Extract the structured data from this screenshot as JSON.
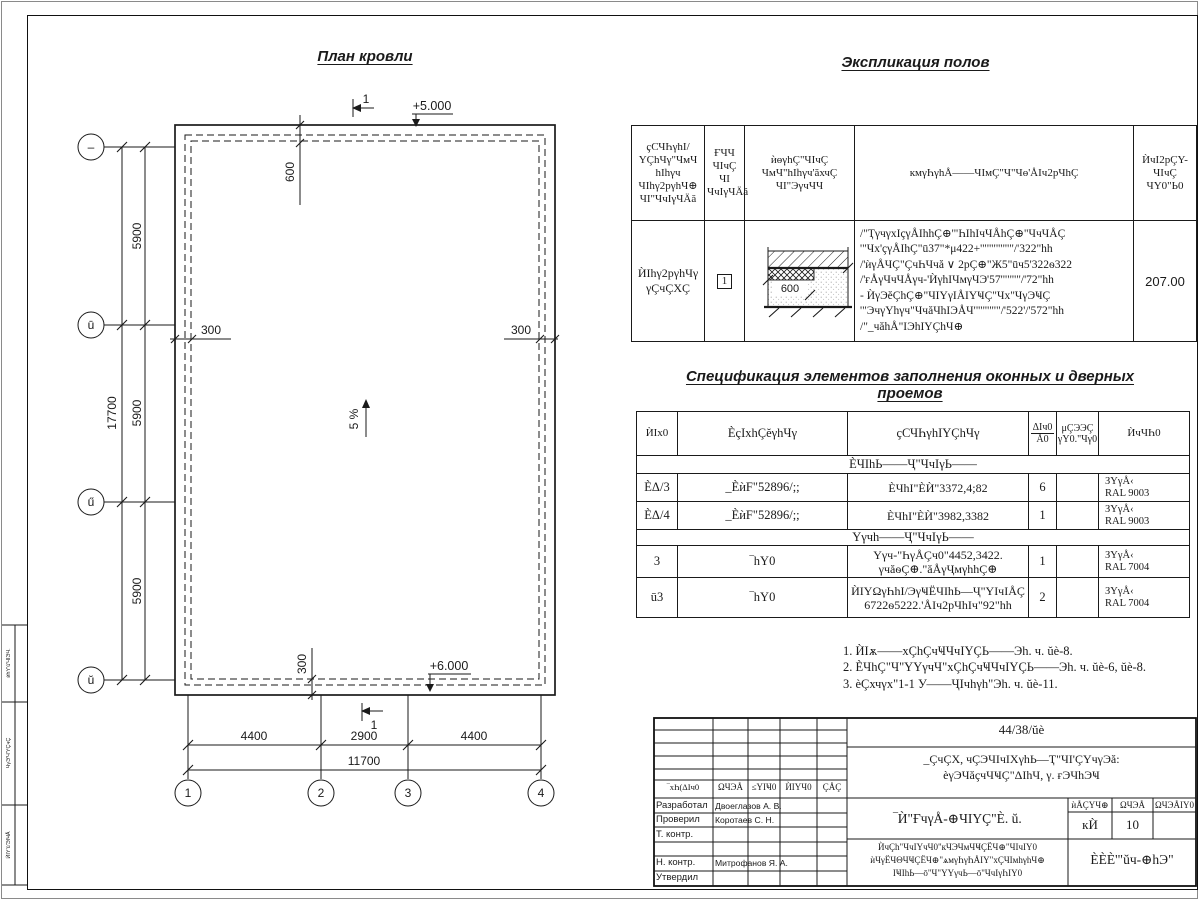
{
  "plan": {
    "title": "План кровли",
    "section_label_top": "1",
    "section_label_bottom": "1",
    "elev_top": "+5.000",
    "elev_bottom": "+6.000",
    "slope_label": "5 %",
    "dim_600": "600",
    "dim_17700": "17700",
    "dim_5900_1": "5900",
    "dim_5900_2": "5900",
    "dim_5900_3": "5900",
    "dim_300_left": "300",
    "dim_300_right": "300",
    "dim_300_bottom": "300",
    "dim_4400_1": "4400",
    "dim_2900": "2900",
    "dim_4400_2": "4400",
    "dim_11700": "11700",
    "rows": [
      "–",
      "ū",
      "ű",
      "ŭ"
    ],
    "cols": [
      "1",
      "2",
      "3",
      "4"
    ],
    "detail_600": "600"
  },
  "explication": {
    "title": "Экспликация полов",
    "headers": {
      "h1": "ҫСЧҺγhI/\nYÇhЧγ\"ЧмЧ\nhIһγч\nЧIһγ2рγhЧ⊕\nЧI\"ЧчIγЧÄă",
      "h2": "ҒЧЧ\nЧIчÇ\nЧI\nЧчIγЧÄă",
      "h3": "ѝѳγhÇ\"ЧIчÇ\nЧмЧ\"hIһγч'ăхчÇ\nЧI\"ЭγчЧЧ",
      "h4": "кмγҺγhÅ——ЧIмÇ\"Ч\"Чѳ'ÅIч2рЧhÇ",
      "h5": "ЍчI2рÇY-\nЧIчÇ\nЧY0\"Ь0"
    },
    "row": {
      "name": "ЍIһγ2рγhЧγ\nγÇчÇХÇ",
      "num": "1",
      "desc": "/\"ҬγчγхIçγÅIhhÇ⊕'\"ҺIhIчЧÅhÇ⊕\"ЧчЧÅÇ\n'\"Чх'çγÅIhÇ\"ū37\"*μ422+'\"'\"'\"'\"'\"/'322\"hh\n/'ѝγÅЧÇ\"ÇчҺЧчă ∨ 2рÇ⊕\"Ж5\"ūч5'322ѳ322\n/'ғÅγЧчЧÅγч-'ЍγhIЧмγЧЭ'57'\"'\"'\"/'72\"hh\n- ЍγЭĕÇhÇ⊕\"ЧIYγIÅIYҸÇ\"Чх\"ЧγЭҸÇ\n'\"ЭчγYhγч\"ЧчăЧhIЭÅЧ'\"'\"'\"'\"/'522'/'572\"hh\n/\"_чăhÅ\"IЭhIYÇhЧ⊕",
      "area": "207.00"
    }
  },
  "specification": {
    "title": "Спецификация элементов заполнения оконных и дверных проемов",
    "headers": [
      "ЍIx0",
      "ÈçIхhÇĕγhЧγ",
      "ҫСЧҺγhIYÇhЧγ",
      "ЍчЧҺ0"
    ],
    "qty_top": "ΔIч0",
    "qty_bottom": "Å0",
    "mass_top": "μÇЭЭÇ",
    "mass_bottom": "γY0.\"Чγ0",
    "section1": "ÈЧIhЬ——Ҷ\"ЧчIγЬ——",
    "section2": "Yγчh——Ҷ\"ЧчIγЬ——",
    "rows": [
      {
        "cells": [
          "ÈΔ/3",
          "_ÈѝF\"52896/;;",
          "ÈЧhI\"ÈЍ\"3372,4;82",
          "6",
          "",
          "ЗYγÅ‹\nRAL 9003"
        ]
      },
      {
        "cells": [
          "ÈΔ/4",
          "_ÈѝF\"52896/;;",
          "ÈЧhI\"ÈЍ\"3982,3382",
          "1",
          "",
          "ЗYγÅ‹\nRAL 9003"
        ]
      },
      {
        "cells": [
          "3",
          "‾hY0",
          "Yγч-\"ҺγÅÇч0\"4452,3422.\nγчăѳÇ⊕.\"ăÅγҶмγhhÇ⊕",
          "1",
          "",
          "ЗYγÅ‹\nRAL 7004"
        ]
      },
      {
        "cells": [
          "ū3",
          "‾hY0",
          "ЍIYΩγҺhI/ЭγҸЁЧIhЬ—Ҷ\"YIчIÅÇ\n6722ѳ5222.'ÅIч2рЧhIч\"92\"hh",
          "2",
          "",
          "ЗYγÅ‹\nRAL 7004"
        ]
      }
    ]
  },
  "notes": {
    "line1": "1. ЍIѫ——хÇhÇчҸЧчIYÇЬ——Эh. ч. ŭè-8.",
    "line2": "2. ÈЧhÇ\"Ч\"YYγчЧ\"хÇhÇчҸЧчIYÇЬ——Эh. ч. ŭè-6, ŭè-8.",
    "line3": "3. èÇхчγх\"1-1 У——ҶIчhγh\"Эh. ч. ŭè-11."
  },
  "title_block": {
    "doc_number": "44/38/ŭè",
    "project_line1": "_ÇчÇХ, чÇЭЧIчIХγhЬ—Ҭ\"ЧI'ÇYчγЭă:",
    "project_line2": "èγЭЧăçчЧҸÇ\"ΔIhЧ, γ. ғЭЧhЭҸ",
    "sheet_title": "‾Ѝ\"ҒчγÅ-⊕ЧIYÇ\"È. ŭ.",
    "stage_h1": "ѝÅÇYЧ⊕",
    "stage_h2": "ΩЧЭÅ",
    "stage_h3": "ΩЧЭÅIY0",
    "stage_v1": "кЍ",
    "stage_v2": "10",
    "stage_v3": "",
    "org_line1": "ЍчÇh\"ЧчIYчЧ0\"кЧЭЧмЧҸÇЁЧ⊕\"ЧIчIY0",
    "org_line2": "ѝЧγЁЧΘЧҸÇЁЧ⊕\"ѧмγҺγҺÅIY\"хÇЧIмhγhЧ⊕",
    "org_line3": "IҸIhЬ—ō\"Ч\"YYγчЬ—ō\"ЧчIγҺIY0",
    "company": "ÈÈÈ'\"ŭч-⊕hЭ\"",
    "sig_headers": [
      "‾хҺ(ΔIч0",
      "ΩЧЭÅ",
      "≤YIҸ0",
      "ЍIYЧ0",
      "ÇÅÇ"
    ],
    "sig_rows": [
      {
        "label": "Разработал",
        "name": "Двоеглазов А. В."
      },
      {
        "label": "Проверил",
        "name": "Коротаев С. Н."
      },
      {
        "label": "Т. контр.",
        "name": ""
      },
      {
        "label": "",
        "name": ""
      },
      {
        "label": "Н. контр.",
        "name": "Митрофанов Я. А."
      },
      {
        "label": "Утвердил",
        "name": ""
      }
    ]
  },
  "margin_stamp": {
    "t1": "ѝhY'ū'ЧIЭЧ.",
    "t2": "ЧγЭ'Ч'YÇчÇ",
    "t3": "ЍIY'ū'ЭIҸÅ"
  }
}
